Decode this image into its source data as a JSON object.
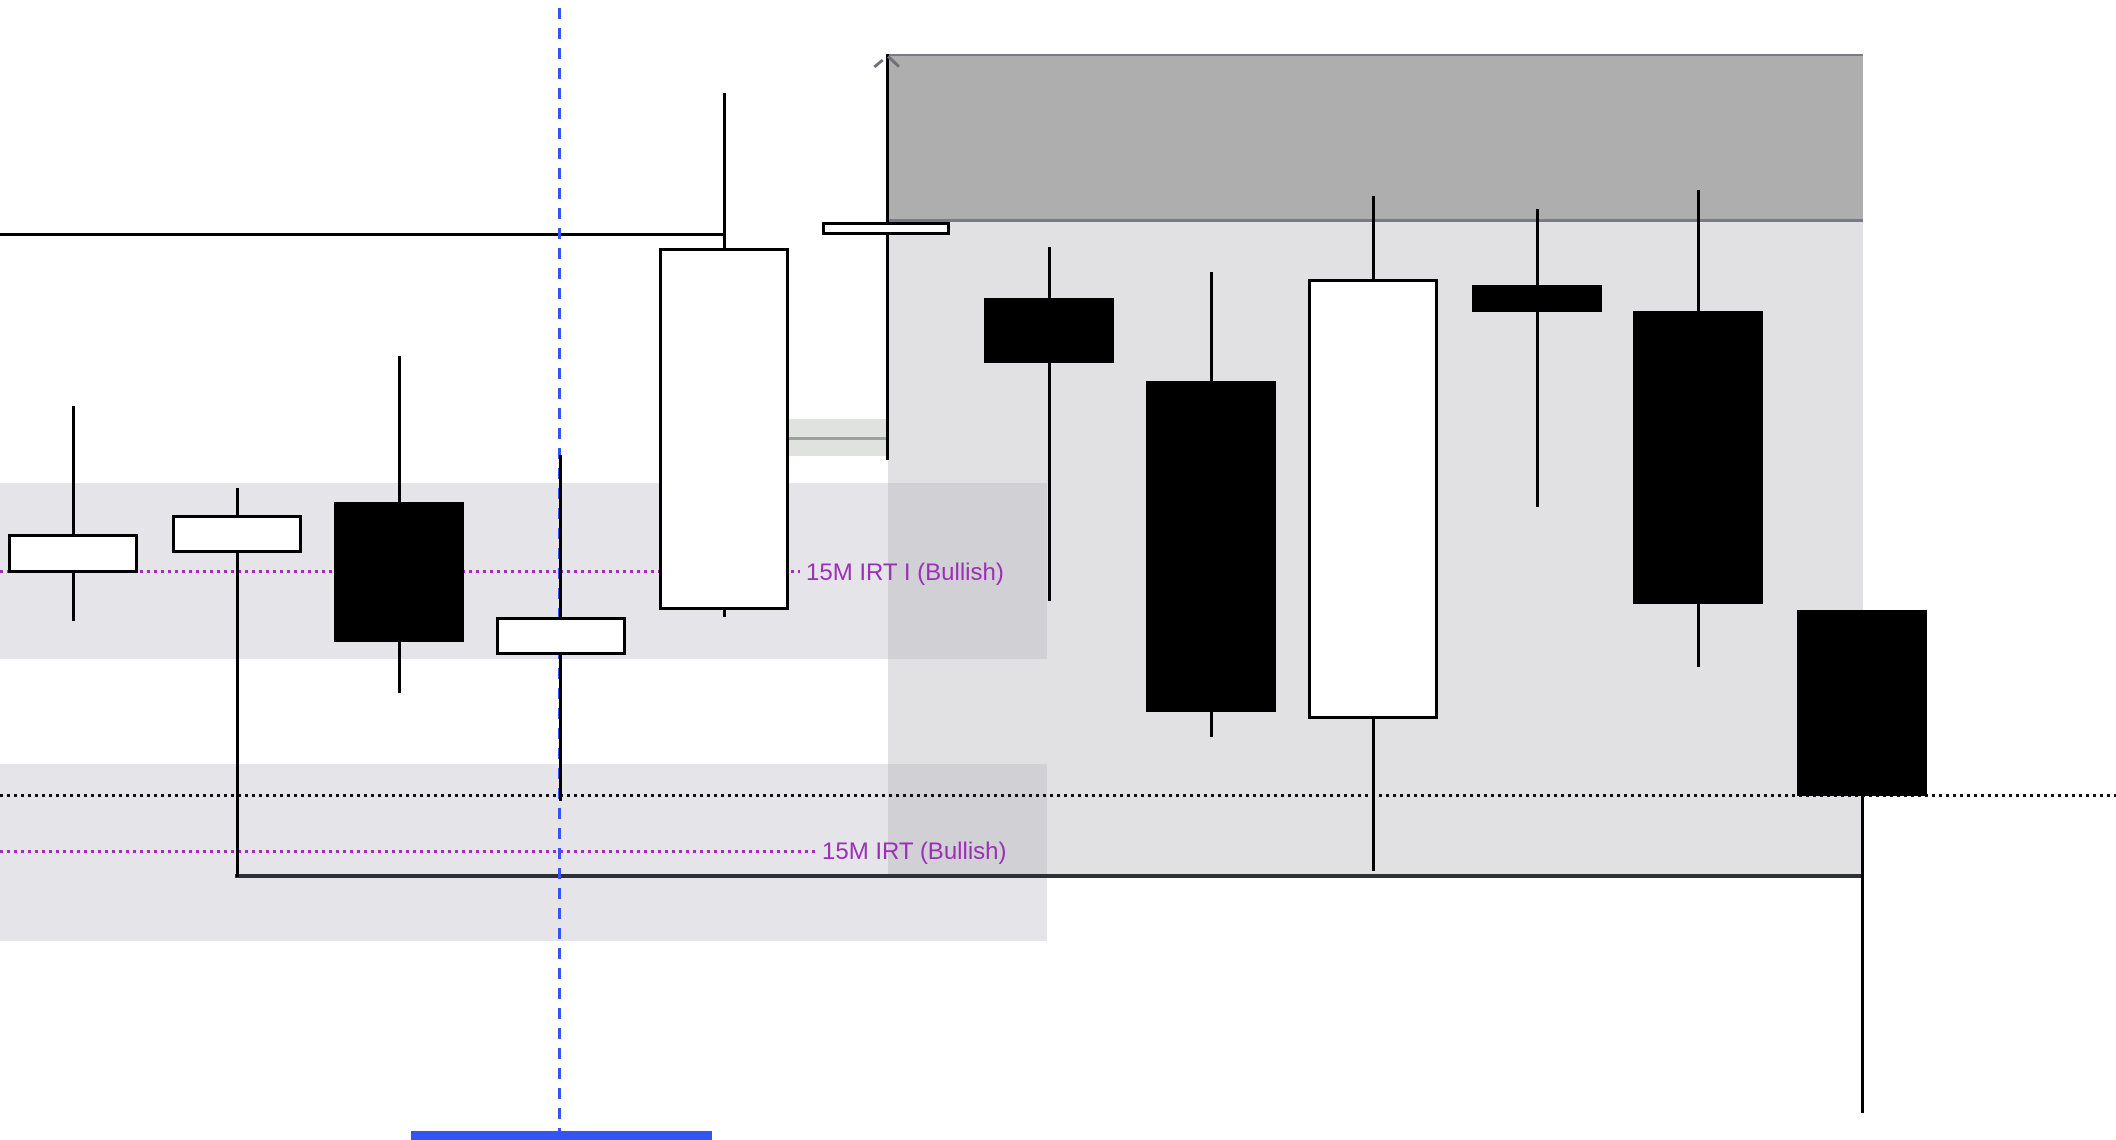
{
  "chart_data": {
    "type": "candlestick",
    "title": "",
    "xlabel": "",
    "ylabel": "",
    "axes_visible": false,
    "grid": false,
    "annotations": [
      {
        "id": "irt1",
        "text": "15M IRT I (Bullish)",
        "color": "#9b2fb5"
      },
      {
        "id": "irt2",
        "text": "15M IRT (Bullish)",
        "color": "#9b2fb5"
      }
    ],
    "colors": {
      "bull_fill": "#ffffff",
      "bear_fill": "#000000",
      "candle_border": "#000000",
      "premium_zone_fill": "#aeaeae",
      "premium_zone_border": "#7b7b85",
      "range_box_fill": "#e1e1e3",
      "band_fill": "rgba(170,170,182,0.30)",
      "imbalance_fill": "#dfe2de",
      "imbalance_midline": "#9aa29a",
      "purple": "#9b2fb5",
      "blue": "#3156f5",
      "dotted_black": "#111111",
      "range_low_line": "#2f2f38",
      "open_line": "#000000",
      "corner_mark": "#70707c"
    },
    "candles": [
      {
        "x": 73,
        "left": 8,
        "right": 138,
        "high": 406,
        "top": 534,
        "bottom": 573,
        "low": 621,
        "dir": "up"
      },
      {
        "x": 237,
        "left": 172,
        "right": 302,
        "high": 488,
        "top": 515,
        "bottom": 553,
        "low": 877,
        "dir": "up"
      },
      {
        "x": 399,
        "left": 334,
        "right": 464,
        "high": 356,
        "top": 502,
        "bottom": 642,
        "low": 693,
        "dir": "down"
      },
      {
        "x": 560,
        "left": 496,
        "right": 626,
        "high": 455,
        "top": 617,
        "bottom": 655,
        "low": 801,
        "dir": "up"
      },
      {
        "x": 724,
        "left": 659,
        "right": 789,
        "high": 93,
        "top": 248,
        "bottom": 610,
        "low": 617,
        "dir": "up"
      },
      {
        "x": 887,
        "left": 822,
        "right": 950,
        "high": 54,
        "top": 222,
        "bottom": 235,
        "low": 460,
        "dir": "up"
      },
      {
        "x": 1049,
        "left": 984,
        "right": 1114,
        "high": 247,
        "top": 298,
        "bottom": 363,
        "low": 601,
        "dir": "down"
      },
      {
        "x": 1211,
        "left": 1146,
        "right": 1276,
        "high": 272,
        "top": 381,
        "bottom": 712,
        "low": 737,
        "dir": "down"
      },
      {
        "x": 1373,
        "left": 1308,
        "right": 1438,
        "high": 196,
        "top": 279,
        "bottom": 719,
        "low": 871,
        "dir": "up"
      },
      {
        "x": 1537,
        "left": 1472,
        "right": 1602,
        "high": 209,
        "top": 285,
        "bottom": 312,
        "low": 507,
        "dir": "down"
      },
      {
        "x": 1698,
        "left": 1633,
        "right": 1763,
        "high": 190,
        "top": 311,
        "bottom": 604,
        "low": 667,
        "dir": "down"
      },
      {
        "x": 1862,
        "left": 1797,
        "right": 1927,
        "high": 610,
        "top": 610,
        "bottom": 796,
        "low": 1113,
        "dir": "down"
      }
    ],
    "zones": [
      {
        "name": "premium-zone-box",
        "x1": 887,
        "x2": 1863,
        "y1": 54,
        "y2": 222,
        "fill": "#aeaeae",
        "border_tb": "#7b7b85"
      },
      {
        "name": "range-box",
        "x1": 888,
        "x2": 1863,
        "y1": 222,
        "y2": 877,
        "fill": "#e1e1e3"
      },
      {
        "name": "irt1-band",
        "x1": 0,
        "x2": 1047,
        "y1": 483,
        "y2": 659,
        "fill": "rgba(170,170,182,0.30)"
      },
      {
        "name": "irt2-band",
        "x1": 0,
        "x2": 1047,
        "y1": 764,
        "y2": 941,
        "fill": "rgba(170,170,182,0.30)"
      },
      {
        "name": "imbalance-box",
        "x1": 789,
        "x2": 887,
        "y1": 419,
        "y2": 456,
        "fill": "#dfe2de",
        "midline": "#9aa29a"
      }
    ],
    "h_lines": [
      {
        "name": "open-level-line",
        "y": 233,
        "x1": 0,
        "x2": 723,
        "w": 3,
        "style": "solid",
        "color": "#000000"
      },
      {
        "name": "range-low-line",
        "y": 874,
        "x1": 235,
        "x2": 1861,
        "w": 4,
        "style": "solid",
        "color": "#2f2f38"
      },
      {
        "name": "equal-lows-dotted-line",
        "y": 794,
        "x1": 0,
        "x2": 2116,
        "w": 3,
        "style": "dotted",
        "color": "#111111"
      },
      {
        "name": "irt1-dotted-line",
        "y": 570,
        "x1": 0,
        "x2": 800,
        "w": 3,
        "style": "dotted",
        "color": "#9b2fb5"
      },
      {
        "name": "irt2-dotted-line",
        "y": 850,
        "x1": 0,
        "x2": 818,
        "w": 3,
        "style": "dotted",
        "color": "#9b2fb5"
      }
    ],
    "v_lines": [
      {
        "name": "anchor-dashed-line",
        "x": 559,
        "y1": 8,
        "y2": 1132,
        "w": 3,
        "style": "dashed",
        "color": "#3156f5"
      }
    ],
    "bars": [
      {
        "name": "session-highlight-bar",
        "x1": 411,
        "x2": 712,
        "y": 1131,
        "h": 9,
        "color": "#3156f5"
      }
    ],
    "corner_marks": [
      {
        "name": "anchor-mark-left",
        "x": 873,
        "y": 62,
        "len": 11,
        "rot": -40,
        "color": "#70707c"
      },
      {
        "name": "anchor-mark-right",
        "x": 886,
        "y": 60,
        "len": 15,
        "rot": 43,
        "color": "#70707c"
      }
    ]
  },
  "labels": {
    "irt1": "15M IRT I (Bullish)",
    "irt2": "15M IRT (Bullish)"
  }
}
